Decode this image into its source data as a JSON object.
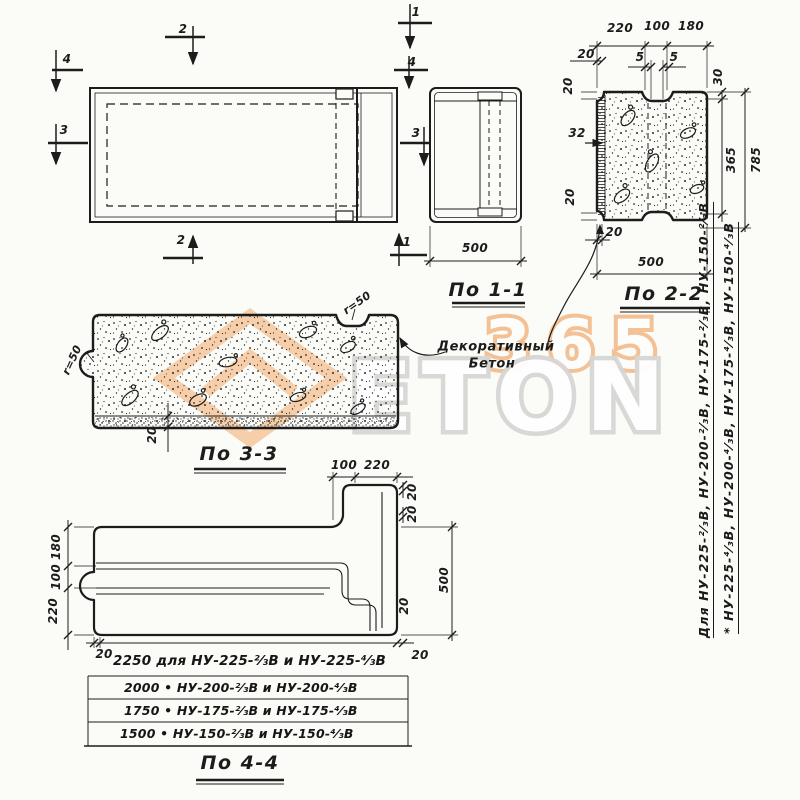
{
  "colors": {
    "ink": "#1c1c1c",
    "paper": "#fbfbf7",
    "orange": "#ef9c55",
    "gray": "#d7d7d5"
  },
  "watermark": {
    "number": "365",
    "letters": "ETON"
  },
  "plan": {
    "mark_top": "2",
    "mark_bottom": "2",
    "mark_left_top": "4",
    "mark_left": "3",
    "mark_right_top": "1",
    "mark_right_4": "4",
    "mark_right_3": "3",
    "mark_right_bottom": "1"
  },
  "view11": {
    "label": "По 1-1",
    "dim_width": "500"
  },
  "view22": {
    "label": "По 2-2",
    "dim_top_left": "220",
    "dim_top_mid": "100",
    "dim_top_right": "180",
    "dim_20_top": "20",
    "dim_5_left": "5",
    "dim_5_right": "5",
    "dim_30_right": "30",
    "dim_20_side_top": "20",
    "dim_32": "32",
    "dim_20_side_bottom": "20",
    "dim_20_bottom": "20",
    "dim_width": "500",
    "dim_365": "365",
    "dim_785": "785"
  },
  "view33": {
    "label": "По 3-3",
    "radius_left": "r=50",
    "radius_top": "r=50",
    "dim_layer": "20"
  },
  "note": {
    "line1": "Декоративный",
    "line2": "Бетон"
  },
  "view44": {
    "label": "По 4-4",
    "dim_100": "100",
    "dim_220": "220",
    "dim_20_rt1": "20",
    "dim_20_rt2": "20",
    "dim_500": "500",
    "dim_20_rb": "20",
    "dim_20_rb2": "20",
    "dim_20_bl": "20",
    "dim_180_left": "180",
    "dim_100_left": "100",
    "dim_220_left": "220"
  },
  "table": {
    "rows": [
      "2250 для НУ-225-²⁄₃В и НУ-225-⁴⁄₃В",
      "2000  •  НУ-200-²⁄₃В и НУ-200-⁴⁄₃В",
      "1750  •  НУ-175-²⁄₃В и НУ-175-⁴⁄₃В",
      "1500  •  НУ-150-²⁄₃В и НУ-150-⁴⁄₃В"
    ]
  },
  "side_note": {
    "line1": "Для НУ-225-²⁄₃В, НУ-200-²⁄₃В, НУ-175-²⁄₃В, НУ-150-²⁄₃В",
    "line2": "*   НУ-225-⁴⁄₃В, НУ-200-⁴⁄₃В, НУ-175-⁴⁄₃В, НУ-150-⁴⁄₃В"
  }
}
